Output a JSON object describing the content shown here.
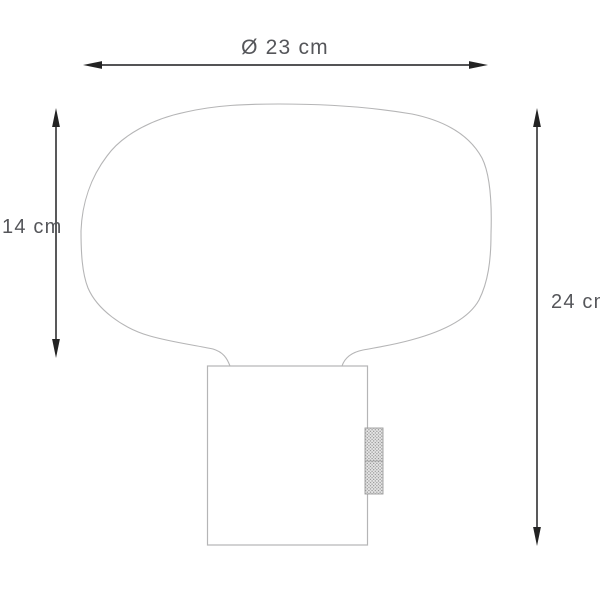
{
  "diagram": {
    "labels": {
      "diameter": "Ø 23 cm",
      "shade_height": "14 cm",
      "total_height": "24 cm"
    },
    "colors": {
      "background": "#ffffff",
      "drawing_outline": "#b5b5b6",
      "dimension_line": "#3c3c3e",
      "arrowhead": "#232323",
      "label_text": "#55565a",
      "knob_background": "#e7e7e7",
      "knob_dot": "#8f8f8f",
      "knob_border": "#9b9b9b"
    }
  }
}
